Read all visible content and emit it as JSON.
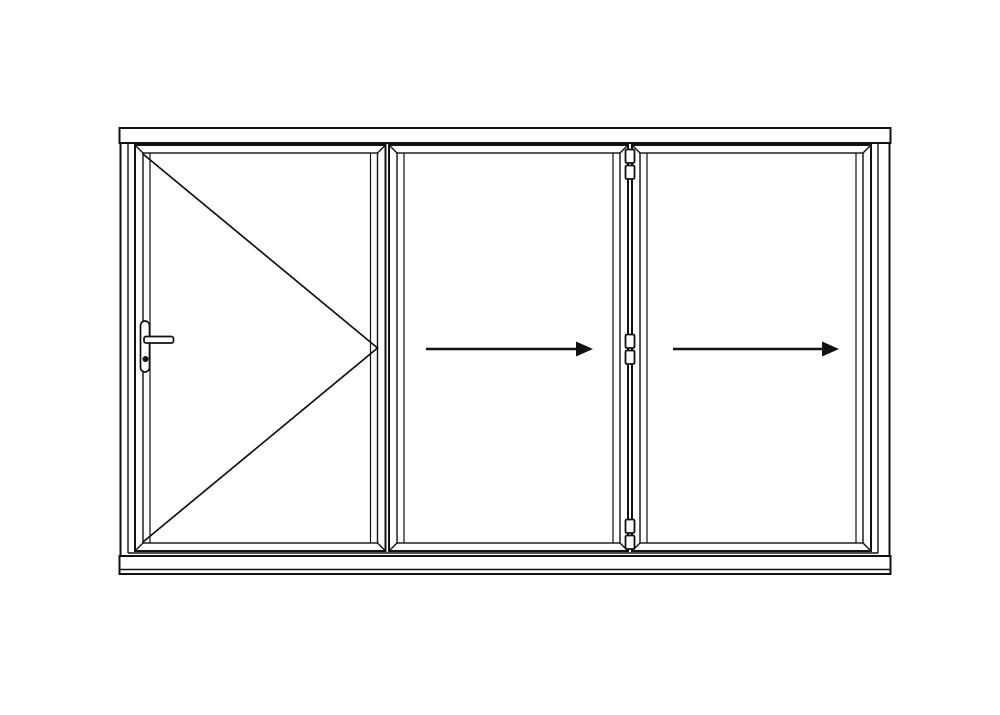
{
  "diagram": {
    "type": "technical-elevation",
    "subject": "3-panel bifold door, left hinged traffic door, panels folding to the right",
    "canvas": {
      "width": 1000,
      "height": 715
    },
    "colors": {
      "background": "#ffffff",
      "line": "#111111"
    },
    "frame": {
      "head": {
        "x": 119.5,
        "y": 128,
        "w": 771,
        "h": 15
      },
      "body": {
        "x": 120.5,
        "y": 143,
        "w": 769,
        "h": 413
      },
      "inner_left_x": 128,
      "inner_right_x": 878,
      "inner_bottom_y": 553,
      "sill": {
        "x": 119.5,
        "y": 556,
        "w": 771,
        "h": 18,
        "front_edge_y": 569.5
      }
    },
    "panel_y": {
      "y1": 145,
      "y2": 551,
      "inner_inset": 8,
      "bevel_inset": 15
    },
    "panels": [
      {
        "id": "panel-1",
        "role": "traffic-door-left-hinged",
        "symbol": "open-swing-v",
        "x1": 135,
        "x2": 385.5
      },
      {
        "id": "panel-2",
        "role": "folding-panel",
        "symbol": "slide-arrow-right",
        "x1": 389,
        "x2": 628
      },
      {
        "id": "panel-3",
        "role": "folding-panel",
        "symbol": "slide-arrow-right",
        "x1": 632,
        "x2": 871
      }
    ],
    "v_symbol": {
      "points": [
        [
          143,
          154
        ],
        [
          377.5,
          348
        ],
        [
          143,
          542
        ]
      ]
    },
    "arrows": [
      {
        "x1": 426,
        "x2": 576,
        "tip_x": 593,
        "y": 349
      },
      {
        "x1": 673,
        "x2": 822,
        "tip_x": 839,
        "y": 349
      }
    ],
    "arrow_half_height": 7.5,
    "hinge_joint": {
      "x_center": 630,
      "knuckle_w": 9,
      "knuckle_h": 13.5,
      "gap": 2.5,
      "pairs_top_y": [
        149.5,
        334.5,
        519.5
      ]
    },
    "handle": {
      "backplate": {
        "x": 140.5,
        "y": 321,
        "w": 9,
        "h": 51,
        "rx": 4.5
      },
      "lever": {
        "x": 144,
        "y": 336.5,
        "w": 29.5,
        "h": 6.5,
        "rx": 2
      },
      "keyhole": {
        "cx": 145.5,
        "cy": 359,
        "r": 3
      }
    }
  }
}
